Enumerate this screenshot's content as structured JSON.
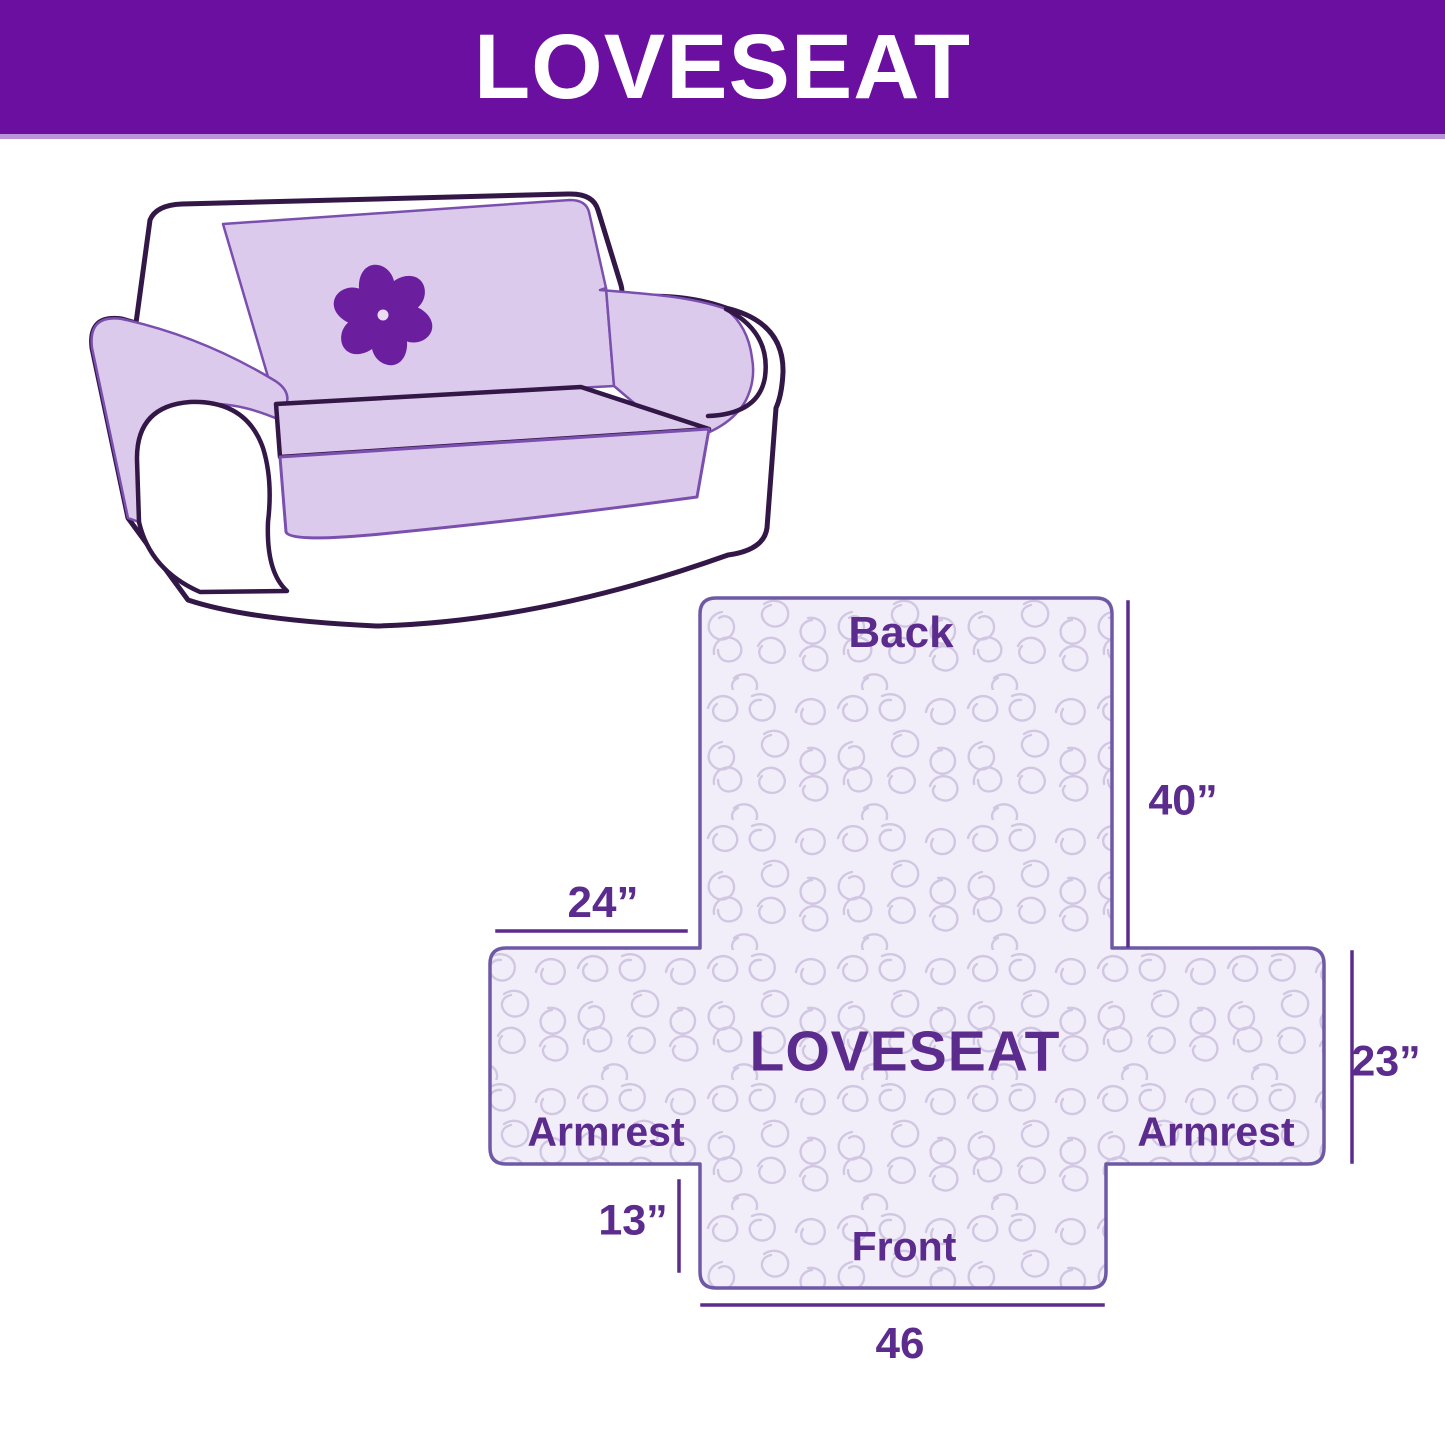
{
  "header": {
    "title": "LOVESEAT",
    "background_color": "#6b0fa0",
    "underline_color": "#bd93d8",
    "text_color": "#ffffff"
  },
  "illustration": {
    "description": "line-art loveseat sofa with quilted slipcover",
    "logo_icon": "pinwheel-flower-icon",
    "cover_color": "#dccaec",
    "outline_color": "#321747",
    "logo_color": "#6b1f9e"
  },
  "diagram": {
    "product_label": "LOVESEAT",
    "pattern": "stipple-meander-quilting",
    "sections": {
      "back": "Back",
      "front": "Front",
      "armrest_left": "Armrest",
      "armrest_right": "Armrest"
    },
    "dimensions": {
      "back_height": "40”",
      "armrest_top_width": "24”",
      "armrest_height": "23”",
      "front_drop": "13”",
      "front_width": "46"
    },
    "fabric_fill_color": "#f2eef9",
    "pattern_line_color": "#d2c7e3",
    "outline_color": "#6f58a5",
    "text_color": "#5c2b8e"
  }
}
